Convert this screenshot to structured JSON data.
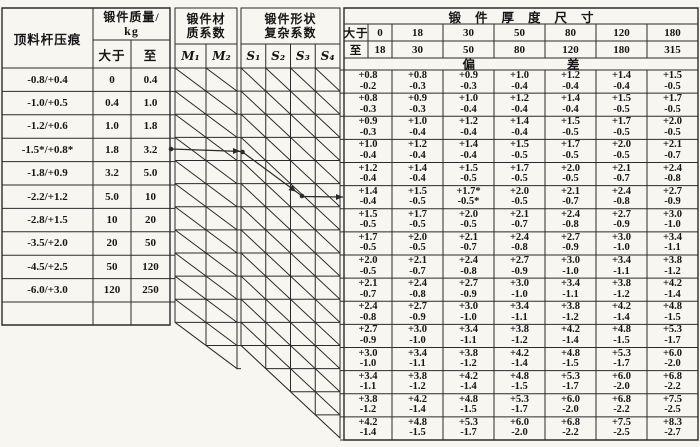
{
  "colors": {
    "ink": "#161616",
    "rule": "#2b2b2b",
    "paper": "#f7f6f1"
  },
  "left_table": {
    "col1_header": "顶料杆压痕",
    "mass_header_line1": "锻件质量/",
    "mass_header_line2": "kg",
    "col_over": "大于",
    "col_to": "至",
    "rows": [
      {
        "indent": "-0.8/+0.4",
        "over": "0",
        "to": "0.4"
      },
      {
        "indent": "-1.0/+0.5",
        "over": "0.4",
        "to": "1.0"
      },
      {
        "indent": "-1.2/+0.6",
        "over": "1.0",
        "to": "1.8"
      },
      {
        "indent": "-1.5*/+0.8*",
        "over": "1.8",
        "to": "3.2"
      },
      {
        "indent": "-1.8/+0.9",
        "over": "3.2",
        "to": "5.0"
      },
      {
        "indent": "-2.2/+1.2",
        "over": "5.0",
        "to": "10"
      },
      {
        "indent": "-2.8/+1.5",
        "over": "10",
        "to": "20"
      },
      {
        "indent": "-3.5/+2.0",
        "over": "20",
        "to": "50"
      },
      {
        "indent": "-4.5/+2.5",
        "over": "50",
        "to": "120"
      },
      {
        "indent": "-6.0/+3.0",
        "over": "120",
        "to": "250"
      }
    ]
  },
  "material_table": {
    "header_line1": "锻件材",
    "header_line2": "质系数",
    "columns": [
      "M₁",
      "M₂"
    ]
  },
  "shape_table": {
    "header_line1": "锻件形状",
    "header_line2": "复杂系数",
    "columns": [
      "S₁",
      "S₂",
      "S₃",
      "S₄"
    ]
  },
  "thickness_table": {
    "title": "锻件厚度尺寸",
    "row_over_label": "大于",
    "row_to_label": "至",
    "over_values": [
      "0",
      "18",
      "30",
      "50",
      "80",
      "120",
      "180"
    ],
    "to_values": [
      "18",
      "30",
      "50",
      "80",
      "120",
      "180",
      "315"
    ],
    "deviation_title": "偏差",
    "deviation_rows": [
      [
        [
          "+0.8",
          "-0.2"
        ],
        [
          "+0.8",
          "-0.3"
        ],
        [
          "+0.9",
          "-0.3"
        ],
        [
          "+1.0",
          "-0.4"
        ],
        [
          "+1.2",
          "-0.4"
        ],
        [
          "+1.4",
          "-0.4"
        ],
        [
          "+1.5",
          "-0.5"
        ]
      ],
      [
        [
          "+0.8",
          "-0.3"
        ],
        [
          "+0.9",
          "-0.3"
        ],
        [
          "+1.0",
          "-0.4"
        ],
        [
          "+1.2",
          "-0.4"
        ],
        [
          "+1.4",
          "-0.4"
        ],
        [
          "+1.5",
          "-0.5"
        ],
        [
          "+1.7",
          "-0.5"
        ]
      ],
      [
        [
          "+0.9",
          "-0.3"
        ],
        [
          "+1.0",
          "-0.4"
        ],
        [
          "+1.2",
          "-0.4"
        ],
        [
          "+1.4",
          "-0.4"
        ],
        [
          "+1.5",
          "-0.5"
        ],
        [
          "+1.7",
          "-0.5"
        ],
        [
          "+2.0",
          "-0.5"
        ]
      ],
      [
        [
          "+1.0",
          "-0.4"
        ],
        [
          "+1.2",
          "-0.4"
        ],
        [
          "+1.4",
          "-0.4"
        ],
        [
          "+1.5",
          "-0.5"
        ],
        [
          "+1.7",
          "-0.5"
        ],
        [
          "+2.0",
          "-0.5"
        ],
        [
          "+2.1",
          "-0.7"
        ]
      ],
      [
        [
          "+1.2",
          "-0.4"
        ],
        [
          "+1.4",
          "-0.4"
        ],
        [
          "+1.5",
          "-0.5"
        ],
        [
          "+1.7",
          "-0.5"
        ],
        [
          "+2.0",
          "-0.5"
        ],
        [
          "+2.1",
          "-0.7"
        ],
        [
          "+2.4",
          "-0.8"
        ]
      ],
      [
        [
          "+1.4",
          "-0.4"
        ],
        [
          "+1.5",
          "-0.5"
        ],
        [
          "+1.7*",
          "-0.5*"
        ],
        [
          "+2.0",
          "-0.5"
        ],
        [
          "+2.1",
          "-0.7"
        ],
        [
          "+2.4",
          "-0.8"
        ],
        [
          "+2.7",
          "-0.9"
        ]
      ],
      [
        [
          "+1.5",
          "-0.5"
        ],
        [
          "+1.7",
          "-0.5"
        ],
        [
          "+2.0",
          "-0.5"
        ],
        [
          "+2.1",
          "-0.7"
        ],
        [
          "+2.4",
          "-0.8"
        ],
        [
          "+2.7",
          "-0.9"
        ],
        [
          "+3.0",
          "-1.0"
        ]
      ],
      [
        [
          "+1.7",
          "-0.5"
        ],
        [
          "+2.0",
          "-0.5"
        ],
        [
          "+2.1",
          "-0.7"
        ],
        [
          "+2.4",
          "-0.8"
        ],
        [
          "+2.7",
          "-0.9"
        ],
        [
          "+3.0",
          "-1.0"
        ],
        [
          "+3.4",
          "-1.1"
        ]
      ],
      [
        [
          "+2.0",
          "-0.5"
        ],
        [
          "+2.1",
          "-0.7"
        ],
        [
          "+2.4",
          "-0.8"
        ],
        [
          "+2.7",
          "-0.9"
        ],
        [
          "+3.0",
          "-1.0"
        ],
        [
          "+3.4",
          "-1.1"
        ],
        [
          "+3.8",
          "-1.2"
        ]
      ],
      [
        [
          "+2.1",
          "-0.7"
        ],
        [
          "+2.4",
          "-0.8"
        ],
        [
          "+2.7",
          "-0.9"
        ],
        [
          "+3.0",
          "-1.0"
        ],
        [
          "+3.4",
          "-1.1"
        ],
        [
          "+3.8",
          "-1.2"
        ],
        [
          "+4.2",
          "-1.4"
        ]
      ],
      [
        [
          "+2.4",
          "-0.8"
        ],
        [
          "+2.7",
          "-0.9"
        ],
        [
          "+3.0",
          "-1.0"
        ],
        [
          "+3.4",
          "-1.1"
        ],
        [
          "+3.8",
          "-1.2"
        ],
        [
          "+4.2",
          "-1.4"
        ],
        [
          "+4.8",
          "-1.5"
        ]
      ],
      [
        [
          "+2.7",
          "-0.9"
        ],
        [
          "+3.0",
          "-1.0"
        ],
        [
          "+3.4",
          "-1.1"
        ],
        [
          "+3.8",
          "-1.2"
        ],
        [
          "+4.2",
          "-1.4"
        ],
        [
          "+4.8",
          "-1.5"
        ],
        [
          "+5.3",
          "-1.7"
        ]
      ],
      [
        [
          "+3.0",
          "-1.0"
        ],
        [
          "+3.4",
          "-1.1"
        ],
        [
          "+3.8",
          "-1.2"
        ],
        [
          "+4.2",
          "-1.4"
        ],
        [
          "+4.8",
          "-1.5"
        ],
        [
          "+5.3",
          "-1.7"
        ],
        [
          "+6.0",
          "-2.0"
        ]
      ],
      [
        [
          "+3.4",
          "-1.1"
        ],
        [
          "+3.8",
          "-1.2"
        ],
        [
          "+4.2",
          "-1.4"
        ],
        [
          "+4.8",
          "-1.5"
        ],
        [
          "+5.3",
          "-1.7"
        ],
        [
          "+6.0",
          "-2.0"
        ],
        [
          "+6.8",
          "-2.2"
        ]
      ],
      [
        [
          "+3.8",
          "-1.2"
        ],
        [
          "+4.2",
          "-1.4"
        ],
        [
          "+4.8",
          "-1.5"
        ],
        [
          "+5.3",
          "-1.7"
        ],
        [
          "+6.0",
          "-2.0"
        ],
        [
          "+6.8",
          "-2.2"
        ],
        [
          "+7.5",
          "-2.5"
        ]
      ],
      [
        [
          "+4.2",
          "-1.4"
        ],
        [
          "+4.8",
          "-1.5"
        ],
        [
          "+5.3",
          "-1.7"
        ],
        [
          "+6.0",
          "-2.0"
        ],
        [
          "+6.8",
          "-2.2"
        ],
        [
          "+7.5",
          "-2.5"
        ],
        [
          "+8.3",
          "-2.7"
        ]
      ]
    ]
  }
}
